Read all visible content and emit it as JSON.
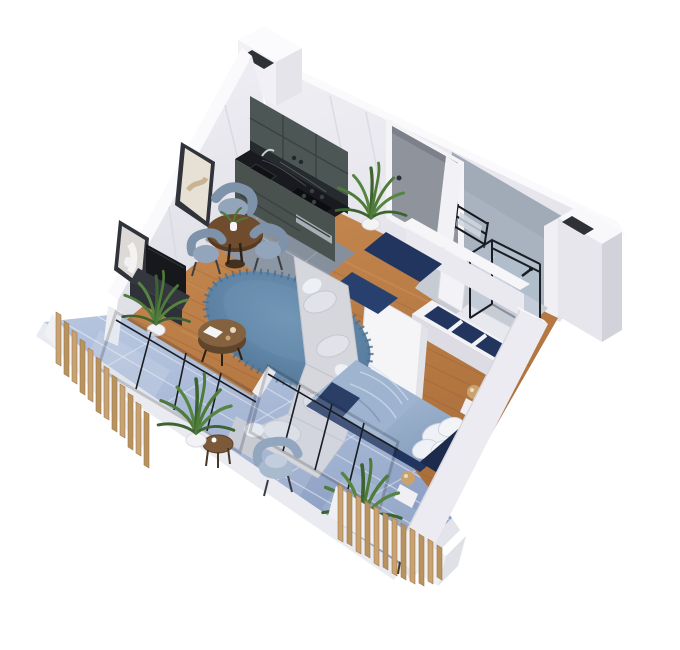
{
  "scene": {
    "view": "isometric-cutaway-apartment-render",
    "rooms": [
      {
        "name": "kitchen",
        "items": [
          "upper-cabinets",
          "base-cabinets",
          "black-marble-countertop",
          "cooktop",
          "sink",
          "gray-tile-floor",
          "potted-plant"
        ]
      },
      {
        "name": "dining-area",
        "items": [
          "round-wood-table",
          "plant-centerpiece",
          "blue-gray-armchair",
          "two-blue-gray-chairs"
        ]
      },
      {
        "name": "living-room",
        "items": [
          "l-shaped-gray-sofa",
          "white-throw-pillows",
          "round-blue-shag-rug",
          "round-wood-coffee-table",
          "tv-console",
          "tv",
          "two-framed-artworks",
          "potted-fern"
        ]
      },
      {
        "name": "hallway",
        "items": [
          "entry-door",
          "navy-runner-rug",
          "navy-doormat",
          "open-white-door",
          "potted-plant"
        ]
      },
      {
        "name": "bathroom",
        "items": [
          "concrete-accent-wall",
          "glass-shower-black-frame",
          "black-towel-rail",
          "shower-tray",
          "open-bath-door"
        ]
      },
      {
        "name": "bedroom",
        "items": [
          "double-bed-blue-bedding",
          "white-pillows",
          "navy-bed-base",
          "navy-headboard",
          "open-shelf-wardrobe-navy-cubbies",
          "gold-sphere-lamp-head",
          "gold-sphere-lamp-foot",
          "glass-partition"
        ]
      },
      {
        "name": "balcony",
        "items": [
          "glossy-blue-tile-floor",
          "wood-slat-screen-left",
          "wood-slat-screen-right",
          "blue-armchair",
          "round-side-table",
          "round-side-table-small",
          "potted-ferns",
          "white-parapet"
        ]
      }
    ],
    "palette": {
      "background": "#FFFFFF",
      "wall": "#ECEBF1",
      "wallRidge": "#FAFAFC",
      "wallOuter": "#E0E0E7",
      "bathWall": "#A9B3BF",
      "woodFloor": "#BC7E47",
      "kitchenTile": "#8D96A3",
      "bathTile": "#C6CBD4",
      "balconyTile": "#9FB2D2",
      "navy": "#22355F",
      "rugBlue": "#5E83A3",
      "sofaGray": "#D6D7DC",
      "bedBlue": "#A5BBD6",
      "pillowWhite": "#EDF1F6",
      "cabinetGreen": "#4C5654",
      "counterBlack": "#191A1F",
      "doorGray": "#8F949C",
      "glassFrame": "#1A1D22",
      "glassTint": "#C3D2E6",
      "plantGreen": "#4E7A3A",
      "slatWood": "#C8A272",
      "gold": "#C9A26C",
      "tableWood": "#6E4C2D",
      "consoleDark": "#34373E",
      "artBeige": "#E7E0D4",
      "artLight": "#DCD9D6"
    }
  }
}
